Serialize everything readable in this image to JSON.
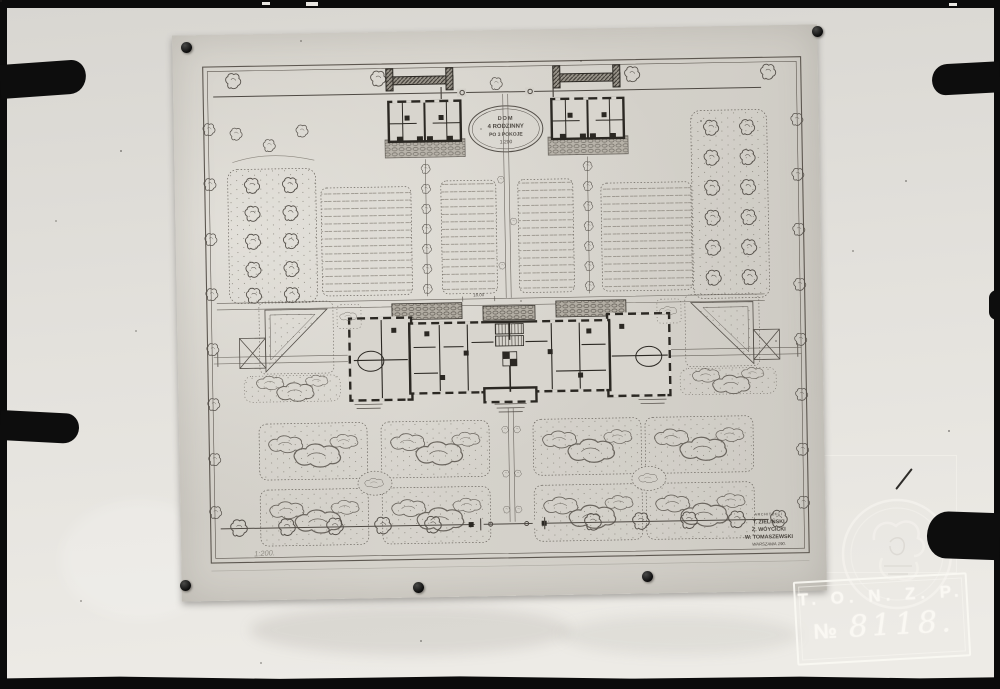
{
  "archive_stamp": {
    "organization": "T. O. N. Z. P.",
    "numero_sign": "№",
    "number": "8118."
  },
  "plan": {
    "cartouche": {
      "line1": "DOM",
      "line2": "4 RODZINNY",
      "line3": "PO 3 POKOJE",
      "line4": "1:200"
    },
    "signature": {
      "heading": "ARCHITEKCI",
      "architect1": "T. ZIELIŃSKI",
      "architect2": "Z. WÓYCICKI",
      "architect3": "W. TOMASZEWSKI",
      "place_line": "WARSZAWA 190."
    },
    "annotations": {
      "scale_note": "1:200.",
      "dimension": "18.00"
    }
  },
  "colors": {
    "mat_paper": "#e2e0db",
    "drawing_sheet": "#d3d0c9",
    "ink": "#4e4943",
    "wall_poche": "#2b2823",
    "stamp_white": "#f8f6f1",
    "photo_black": "#0b0b0b"
  }
}
